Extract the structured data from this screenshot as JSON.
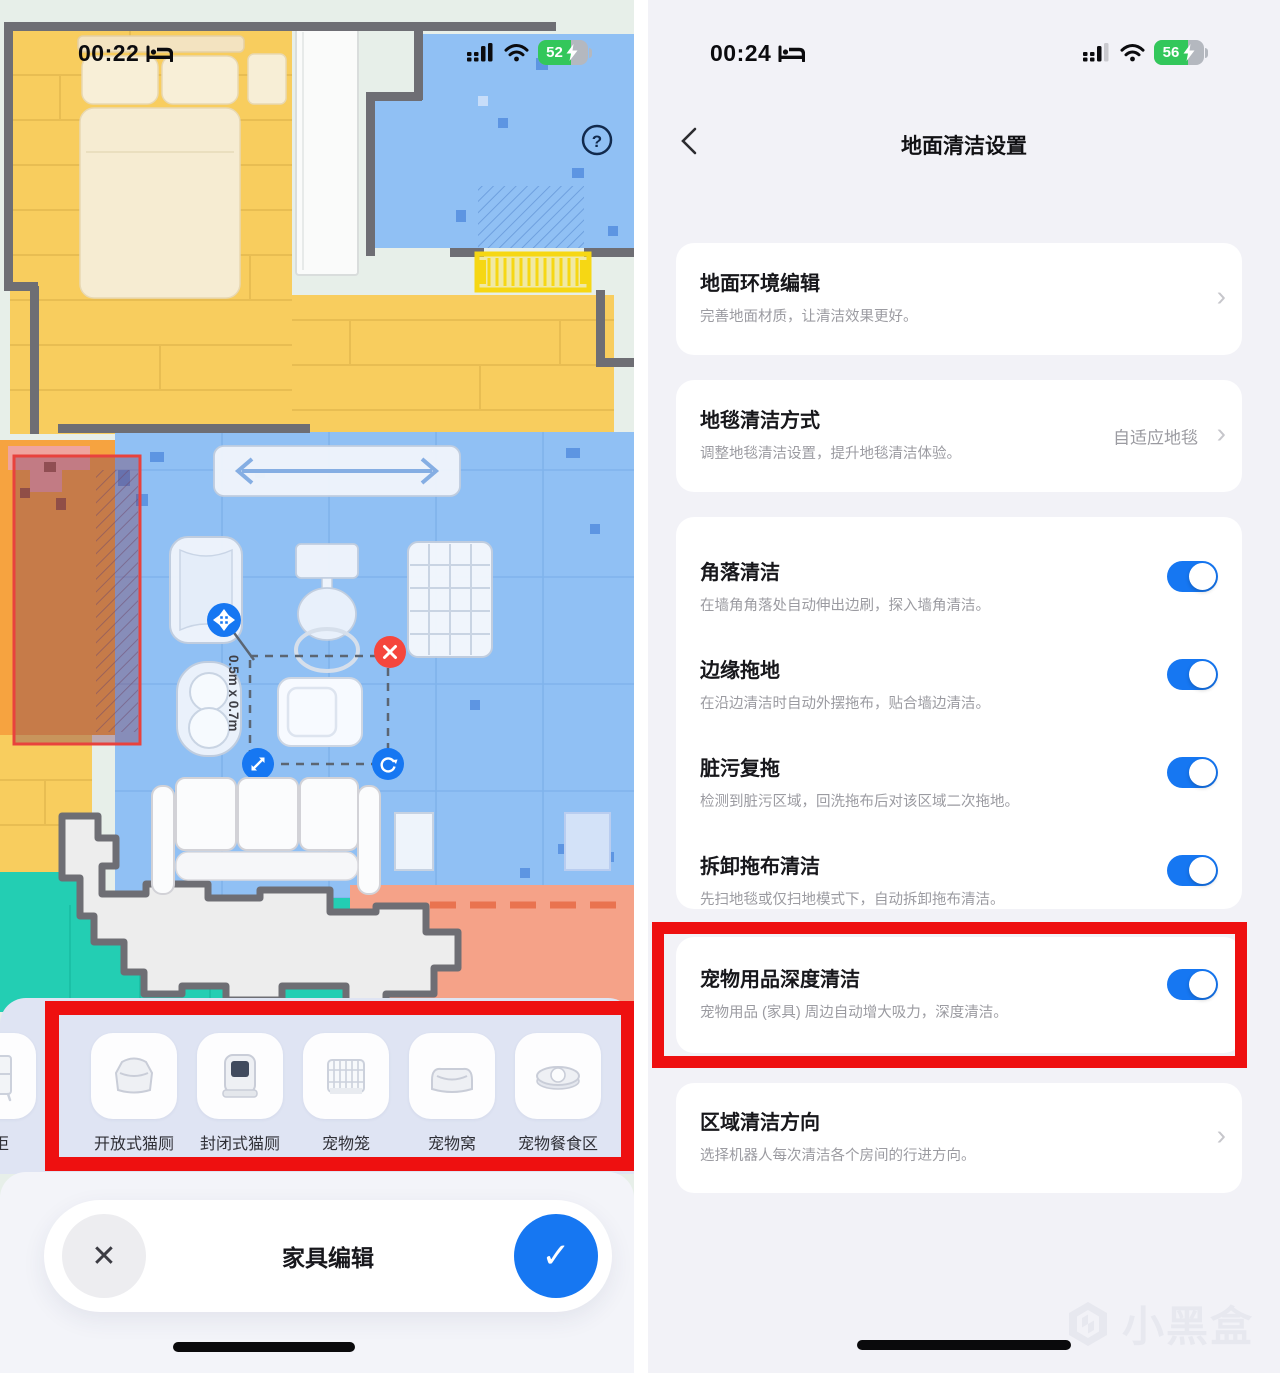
{
  "left_screen": {
    "status_bar": {
      "time": "00:22",
      "battery_percent": "52"
    },
    "map": {
      "help_label": "?",
      "selection_dimension": "0.5m x 0.7m"
    },
    "furniture_tray": {
      "partial_item_label": "头柜",
      "items": [
        {
          "label": "开放式猫厕"
        },
        {
          "label": "封闭式猫厕"
        },
        {
          "label": "宠物笼"
        },
        {
          "label": "宠物窝"
        },
        {
          "label": "宠物餐食区"
        }
      ]
    },
    "bottom_bar": {
      "title": "家具编辑"
    }
  },
  "right_screen": {
    "status_bar": {
      "time": "00:24",
      "battery_percent": "56"
    },
    "header": {
      "title": "地面清洁设置"
    },
    "cards": {
      "floor_env": {
        "title": "地面环境编辑",
        "subtitle": "完善地面材质，让清洁效果更好。"
      },
      "carpet": {
        "title": "地毯清洁方式",
        "subtitle": "调整地毯清洁设置，提升地毯清洁体验。",
        "value": "自适应地毯"
      },
      "toggles": [
        {
          "title": "角落清洁",
          "subtitle": "在墙角角落处自动伸出边刷，探入墙角清洁。",
          "enabled": true
        },
        {
          "title": "边缘拖地",
          "subtitle": "在沿边清洁时自动外摆拖布，贴合墙边清洁。",
          "enabled": true
        },
        {
          "title": "脏污复拖",
          "subtitle": "检测到脏污区域，回洗拖布后对该区域二次拖地。",
          "enabled": true
        },
        {
          "title": "拆卸拖布清洁",
          "subtitle": "先扫地毯或仅扫地模式下，自动拆卸拖布清洁。",
          "enabled": true
        }
      ],
      "pet": {
        "title": "宠物用品深度清洁",
        "subtitle": "宠物用品 (家具) 周边自动增大吸力，深度清洁。",
        "enabled": true
      },
      "zone_direction": {
        "title": "区域清洁方向",
        "subtitle": "选择机器人每次清洁各个房间的行进方向。"
      }
    },
    "watermark": "小黑盒"
  },
  "colors": {
    "accent_blue": "#1677F2",
    "annotation_red": "#EE1010",
    "battery_green": "#33C75B"
  }
}
